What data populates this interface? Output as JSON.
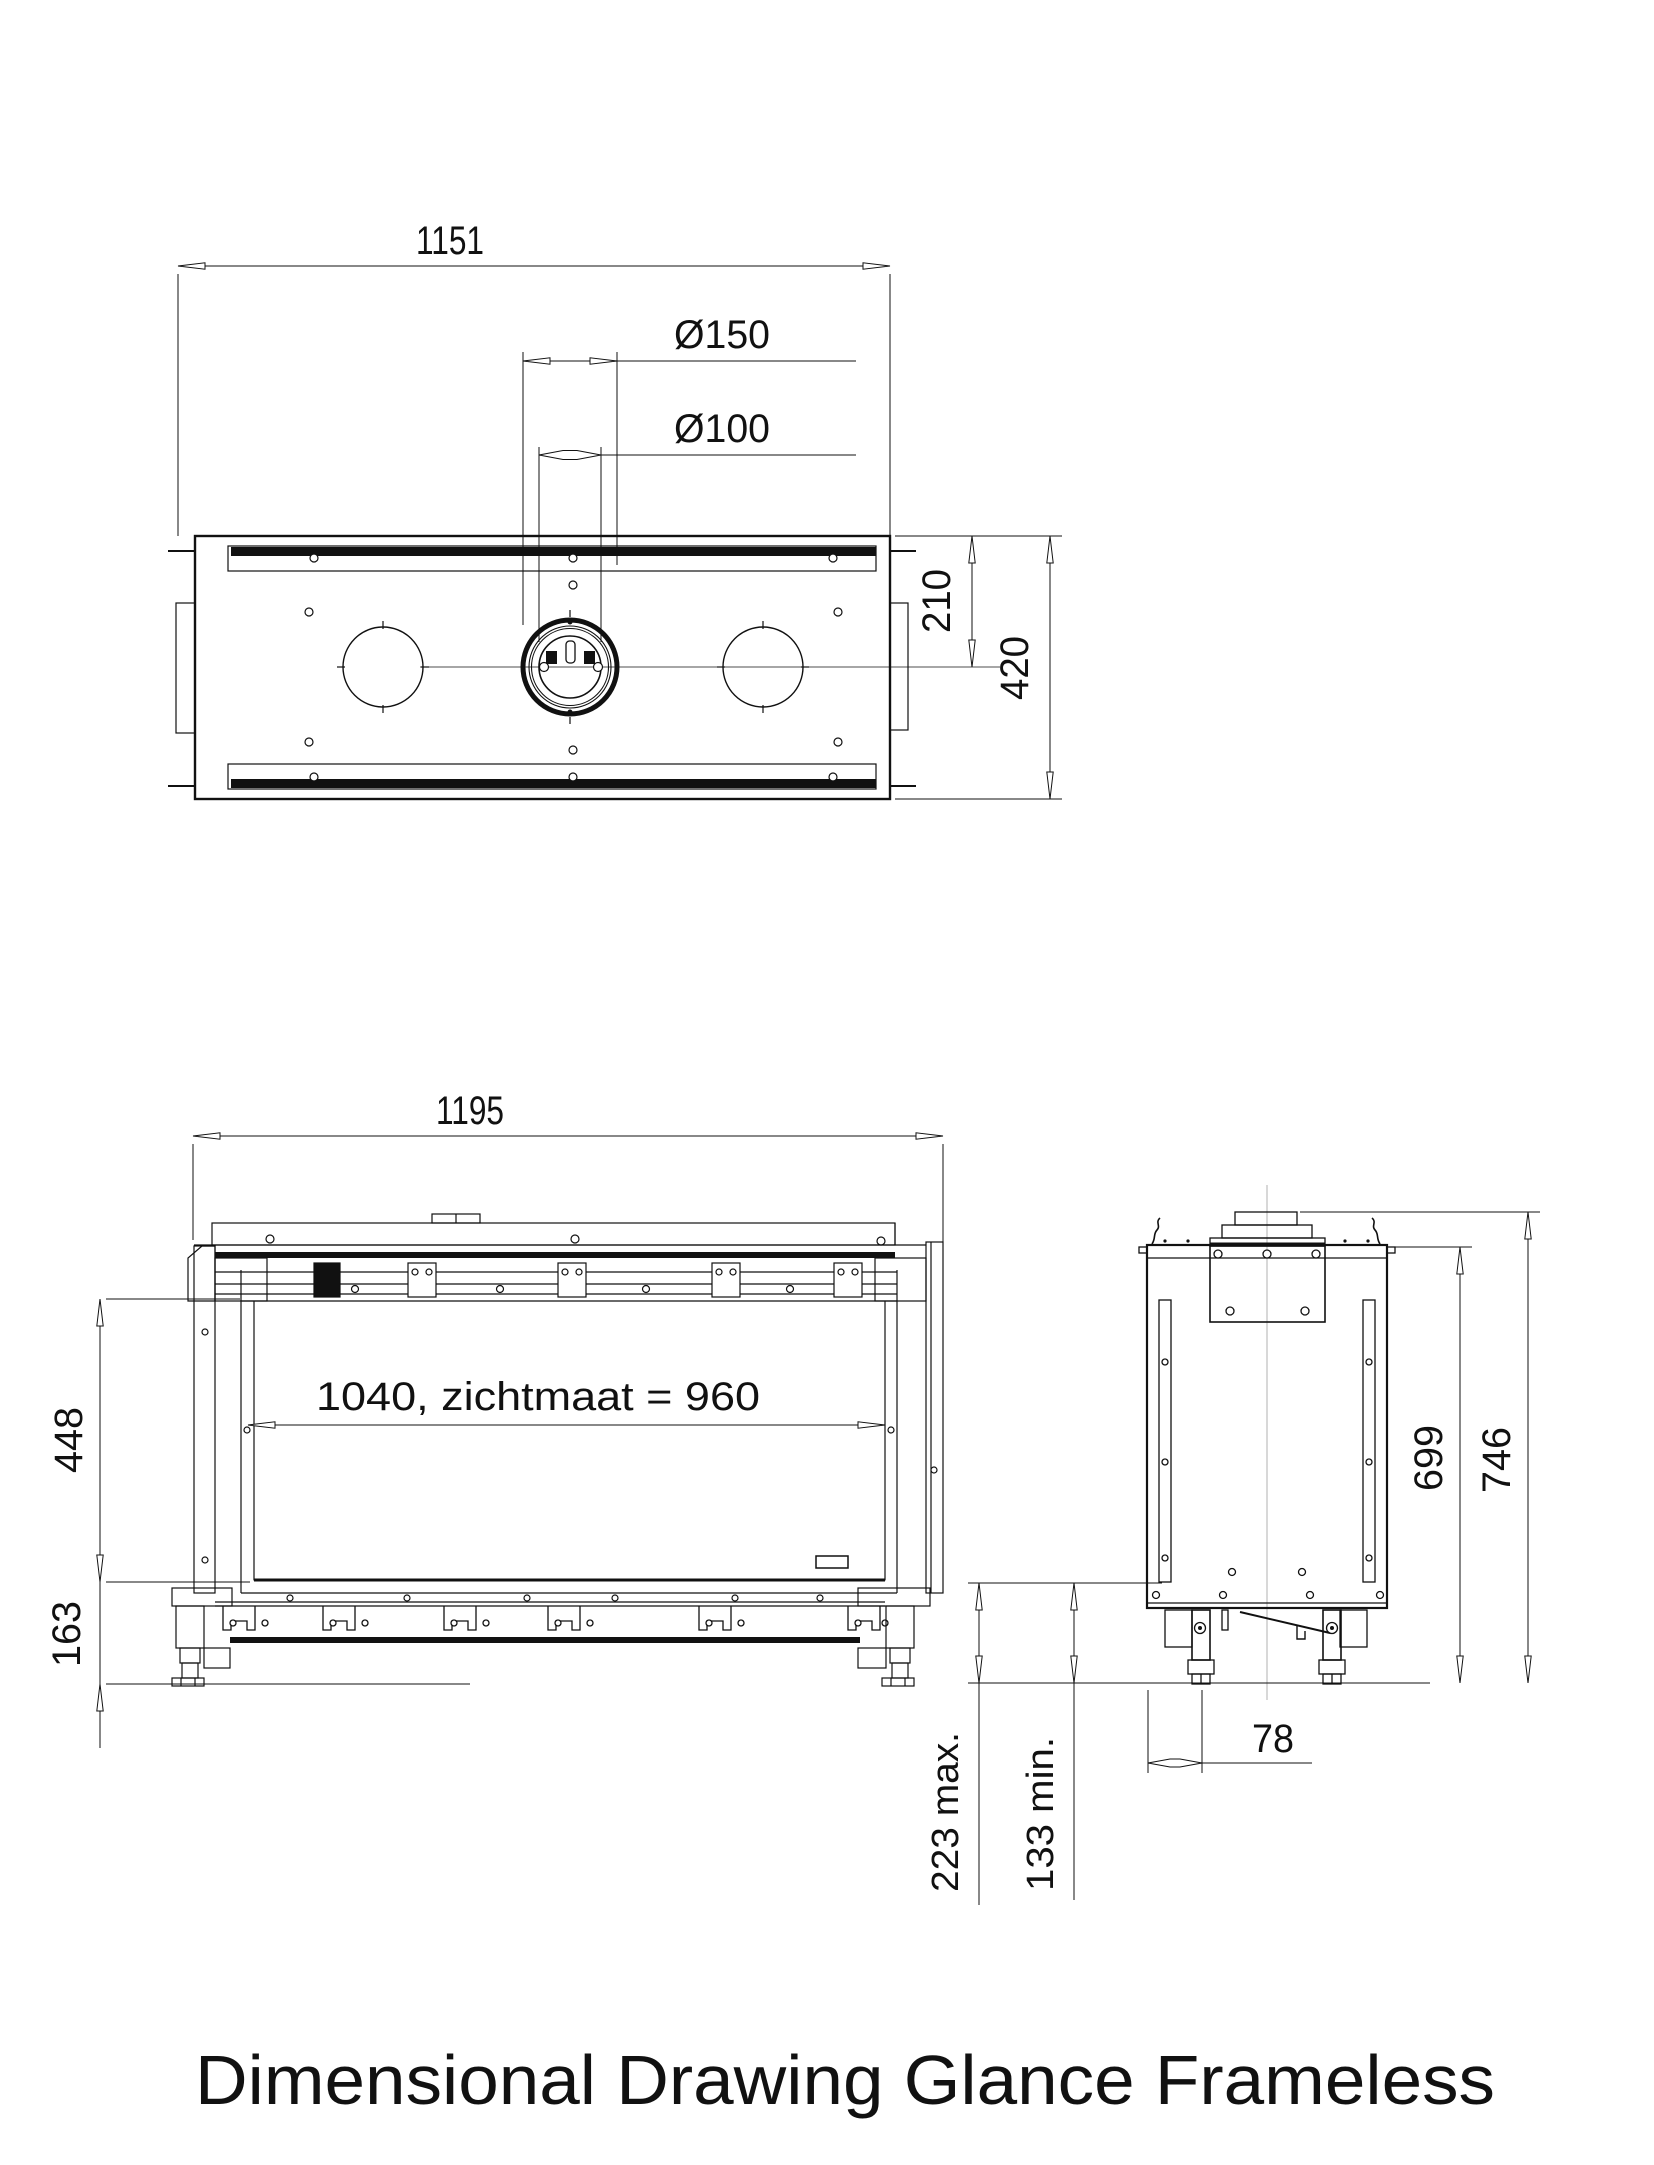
{
  "title": "Dimensional Drawing Glance Frameless",
  "top_view": {
    "overall_width": "1151",
    "flue_diameter_outer": "Ø150",
    "flue_diameter_inner": "Ø100",
    "flue_offset_from_front": "210",
    "overall_depth": "420"
  },
  "front_view": {
    "overall_width": "1195",
    "glass_height": "448",
    "plinth_height": "163",
    "opening_width": "1040, zichtmaat = 960"
  },
  "side_view": {
    "height_to_top_plate": "699",
    "overall_height": "746",
    "leg_inset": "78",
    "floor_clearance_max": "223 max.",
    "floor_clearance_min": "133 min."
  }
}
